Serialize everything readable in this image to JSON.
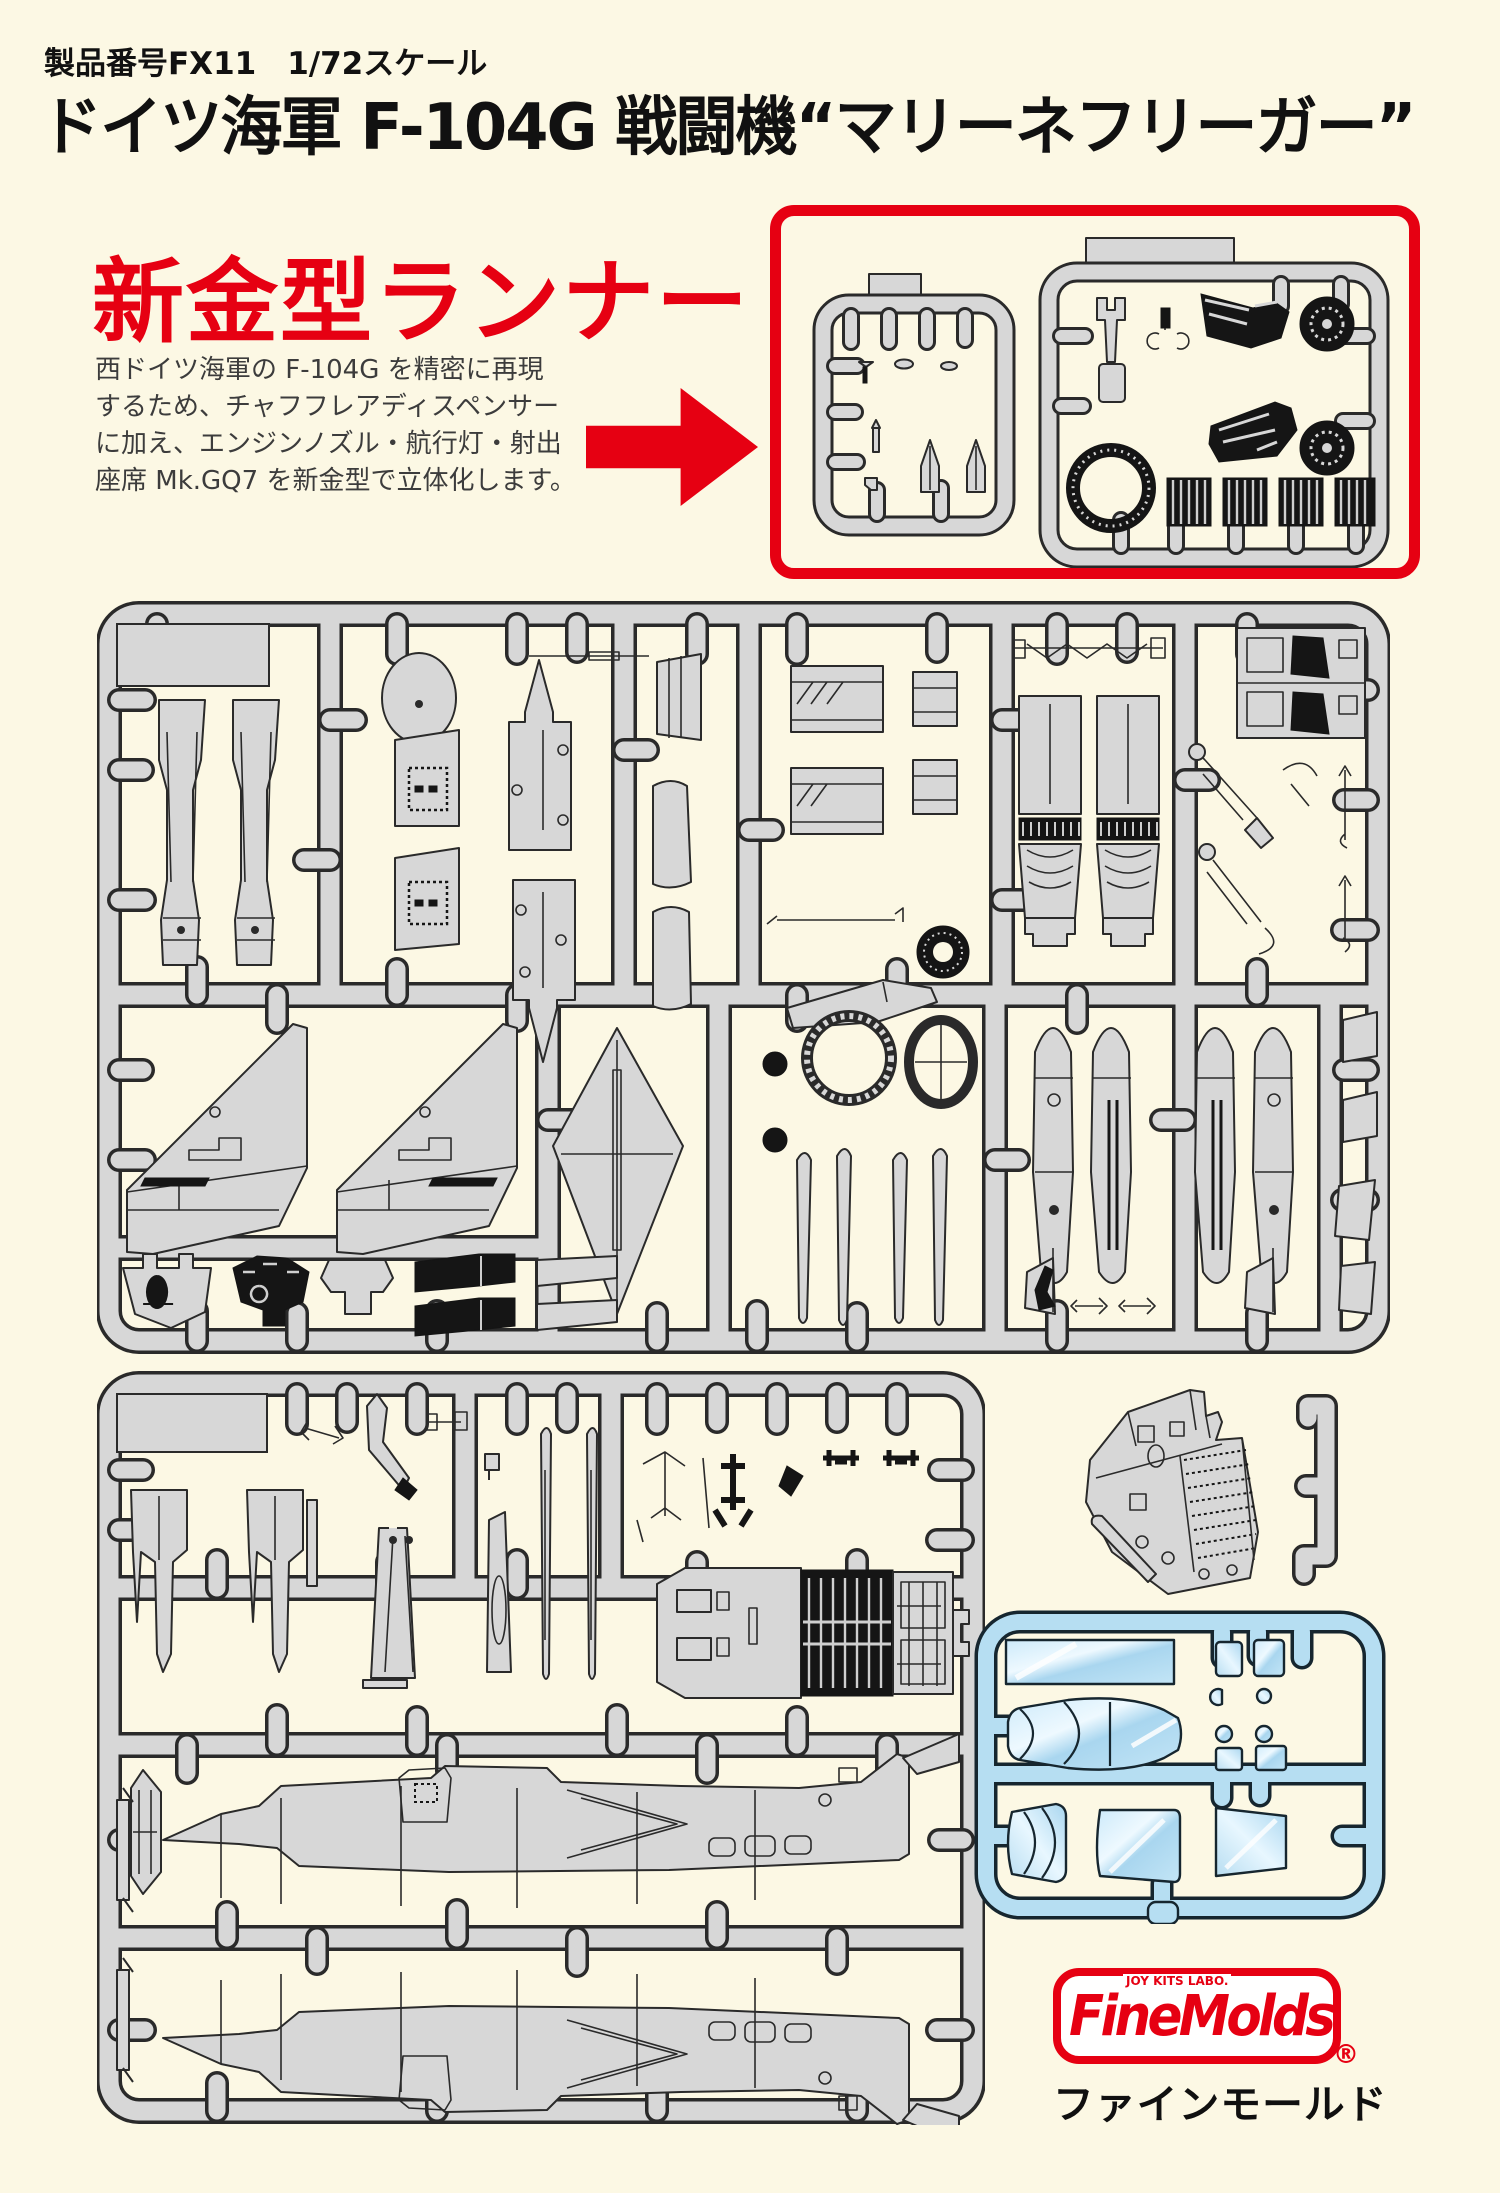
{
  "page": {
    "background": "#FCF8E4",
    "accent_red": "#E60012",
    "sprue_gray": "#D7D7D7",
    "sprue_outline": "#2A2A2A",
    "clear_blue": "#B6DEF2"
  },
  "header": {
    "product_line": "製品番号FX11　1/72スケール",
    "title": "ドイツ海軍 F-104G 戦闘機“マリーネフリーガー”"
  },
  "promo": {
    "headline": "新金型ランナー",
    "body_lines": [
      "西ドイツ海軍の F-104G を精密に再現",
      "するため、チャフフレアディスペンサー",
      "に加え、エンジンノズル・航行灯・射出",
      "座席 Mk.GQ7 を新金型で立体化します。"
    ]
  },
  "figures": {
    "new_runner_box": "new-mold runner sprues (highlighted)",
    "sprue_panel_1": "main parts sprue: tail halves, intakes, nozzles, wings, tailplane, fuel tanks",
    "sprue_panel_2": "parts sprue: gear doors, cockpit tub, fuselage halves",
    "tail_fin_part": "vertical tail fin part",
    "clear_sprue": "clear parts sprue: canopy, windshield, lights"
  },
  "brand": {
    "logo_top": "JOY KITS LABO.",
    "logo_main": "FineMolds",
    "registered": "®",
    "logo_kana": "ファインモールド"
  }
}
